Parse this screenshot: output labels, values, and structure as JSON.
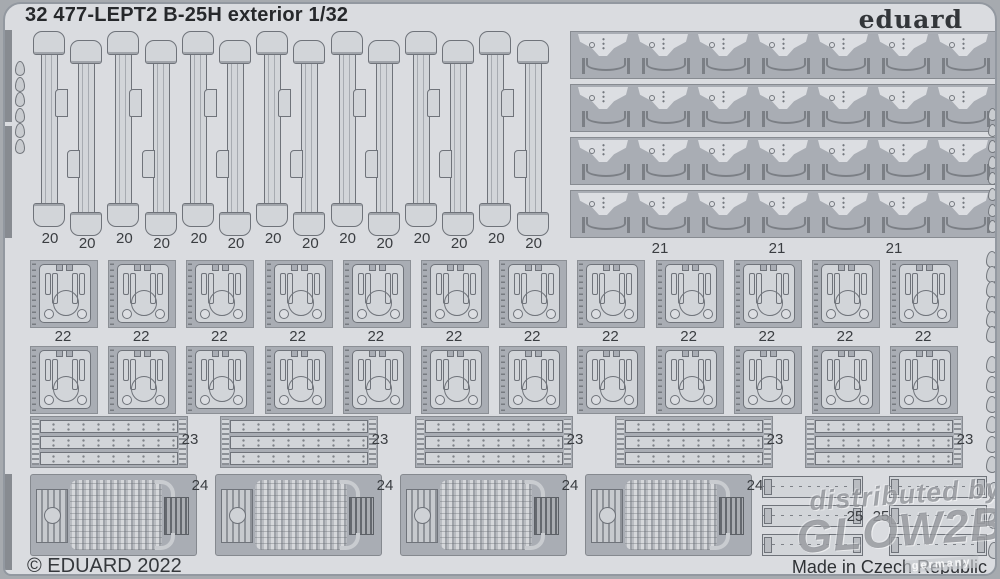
{
  "header": {
    "title": "32 477-LEPT2 B-25H exterior 1/32",
    "brand": "eduard"
  },
  "footer": {
    "copyright": "© EDUARD 2022",
    "made_in": "Made in Czech Republic"
  },
  "watermark": {
    "line1": "distributed by",
    "line2": "GLOW2B",
    "line3": "germany"
  },
  "colors": {
    "sheet": "#dadce0",
    "recess": "#a9adb4",
    "part": "#d2d5d9",
    "outline": "#6f737a",
    "frame": "#a6aaaf",
    "text": "#26282b"
  },
  "parts": {
    "strips20": {
      "label": "20",
      "count": 14
    },
    "brackets21": {
      "label": "21",
      "rows": 4,
      "per_row": 7,
      "label_count": 3
    },
    "panels22": {
      "label": "22",
      "rows": 2,
      "per_row": 12
    },
    "plates23": {
      "label": "23",
      "count": 5,
      "strips_per_block": 3
    },
    "grills24": {
      "label": "24",
      "count": 4
    },
    "strips25": {
      "label": "25",
      "count": 2,
      "strips_per_group": 3
    }
  }
}
